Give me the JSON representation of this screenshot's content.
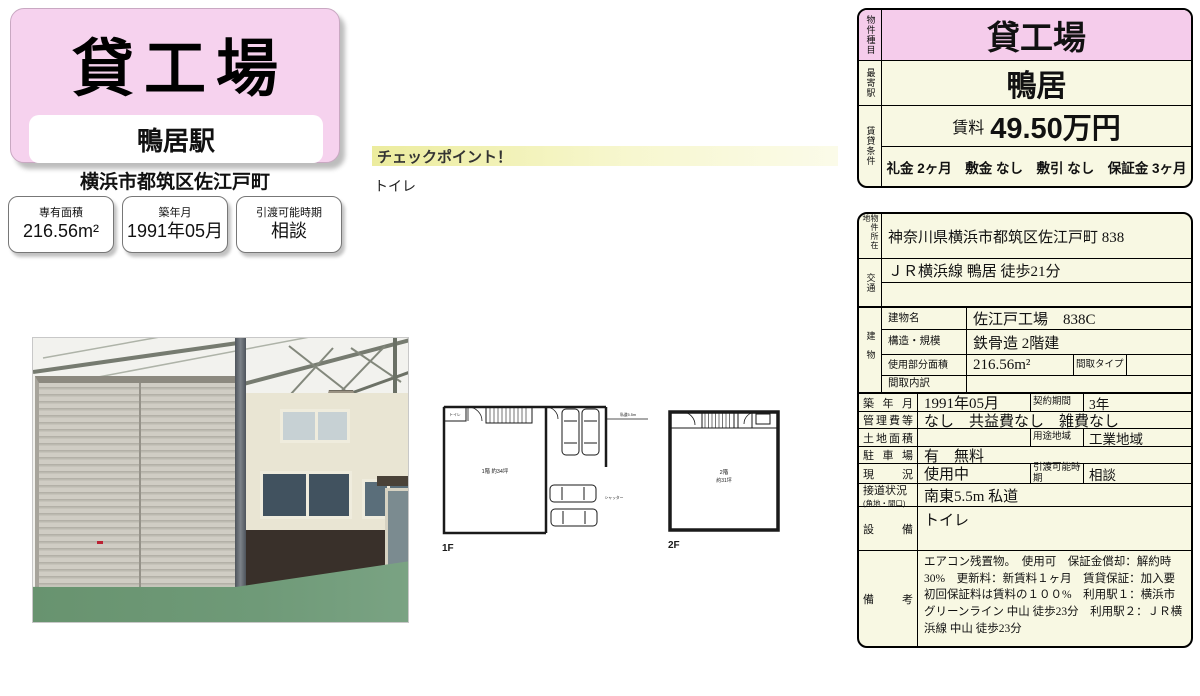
{
  "colors": {
    "pink": "#f5cceb",
    "cream": "#f8f8e3",
    "checkpoint_yellow": "#ecec9e",
    "floor_green": "#6f9a78",
    "accent_border": "#000000"
  },
  "header": {
    "title": "貸工場",
    "station": "鴨居駅",
    "address": "横浜市都筑区佐江戸町",
    "stats": [
      {
        "label": "専有面積",
        "value": "216.56m²"
      },
      {
        "label": "築年月",
        "value": "1991年05月"
      },
      {
        "label": "引渡可能時期",
        "value": "相談"
      }
    ]
  },
  "checkpoint": {
    "title": "チェックポイント！",
    "body": "トイレ"
  },
  "floorplans": {
    "f1": {
      "label": "1F",
      "toilet": "トイレ",
      "area": "1階 約34坪",
      "shutter": "シャッター",
      "road": "私道5.5m"
    },
    "f2": {
      "label": "2F",
      "area_line1": "2階",
      "area_line2": "約31坪"
    }
  },
  "summary_table": {
    "type_label": "物件種目",
    "type_value": "貸工場",
    "station_label": "最寄駅",
    "station_value": "鴨居",
    "terms_label": "賃貸条件",
    "rent_label": "賃料",
    "rent_value": "49.50万円",
    "terms_value": "礼金 2ヶ月　敷金 なし　敷引 なし　保証金 3ヶ月"
  },
  "detail_table": {
    "location_label": "物件所在地",
    "location": "神奈川県横浜市都筑区佐江戸町 838",
    "access_label": "交通",
    "access": "ＪＲ横浜線 鴨居 徒歩21分",
    "access_line2": "",
    "building_label": "建物",
    "building_rows": [
      {
        "label": "建物名",
        "value": "佐江戸工場　838C"
      },
      {
        "label": "構造・規模",
        "value": "鉄骨造 2階建"
      },
      {
        "label": "使用部分面積",
        "value": "216.56m²",
        "label2": "間取タイプ",
        "value2": ""
      },
      {
        "label": "間取内訳",
        "value": ""
      }
    ],
    "rows": [
      {
        "label": "築年月",
        "value": "1991年05月",
        "label2": "契約期間",
        "value2": "3年"
      },
      {
        "label": "管理費等",
        "value": "なし　共益費なし　雑費なし"
      },
      {
        "label": "土地面積",
        "value": "",
        "label2": "用途地域",
        "value2": "工業地域"
      },
      {
        "label": "駐車場",
        "value": "有　無料"
      },
      {
        "label": "現　況",
        "value": "使用中",
        "label2": "引渡可能時期",
        "value2": "相談"
      },
      {
        "label": "接道状況",
        "sublabel": "(角地・間口)",
        "value": "南東5.5m 私道"
      },
      {
        "label": "設　備",
        "value": "トイレ"
      },
      {
        "label": "備　考",
        "value": "エアコン残置物。　使用可　保証金償却：解約時30%　更新料：新賃料１ヶ月　賃貸保証：加入要 初回保証料は賃料の１００%　利用駅１：横浜市グリーンライン 中山 徒歩23分　利用駅２：ＪＲ横浜線 中山 徒歩23分"
      }
    ]
  }
}
